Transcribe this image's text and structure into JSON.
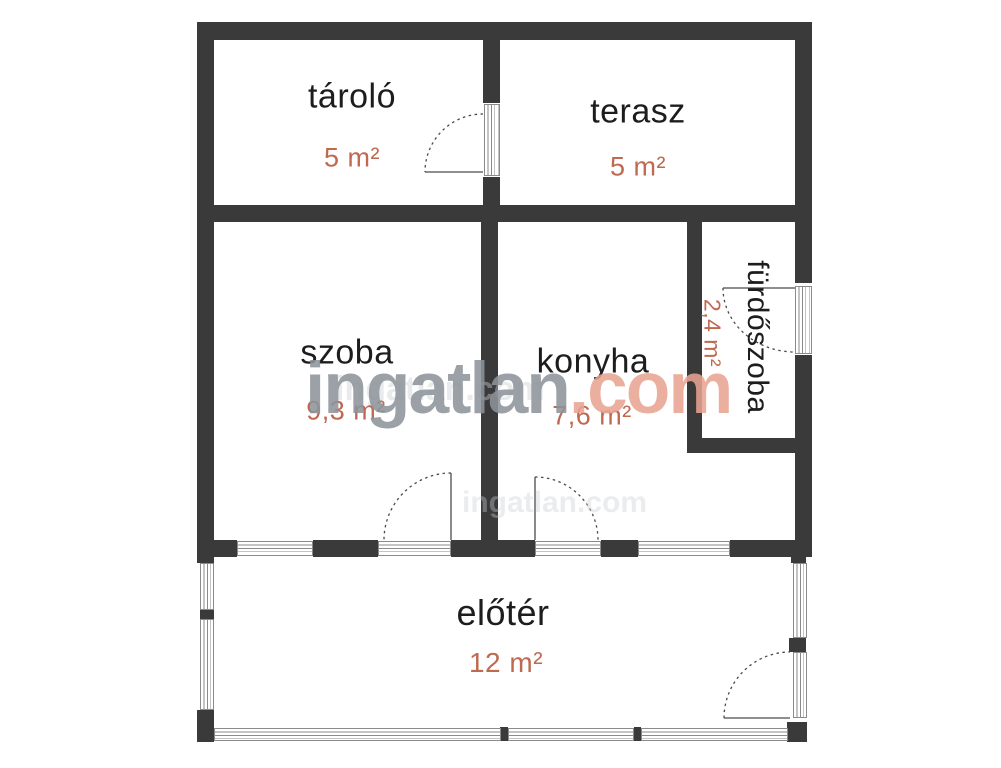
{
  "rooms": {
    "tarolo": {
      "name": "tároló",
      "area": "5 m²"
    },
    "terasz": {
      "name": "terasz",
      "area": "5 m²"
    },
    "szoba": {
      "name": "szoba",
      "area": "9,3 m²"
    },
    "konyha": {
      "name": "konyha",
      "area": "7,6 m²"
    },
    "furdoszoba": {
      "name": "fürdőszoba",
      "area": "2,4 m²"
    },
    "eloter": {
      "name": "előtér",
      "area": "12 m²"
    }
  },
  "watermark": {
    "brand": "ingatlan",
    "suffix": ".com",
    "ghost": "ingatlan.com"
  },
  "colors": {
    "wall": "#3a3a3a",
    "room_name": "#1d1d1d",
    "area_accent": "#bf6950",
    "watermark_gray": "#8d949b",
    "watermark_accent": "#e9a492",
    "frame": "#8a8a8a",
    "arc": "#4a4a4a",
    "ghost": "#cbced2"
  }
}
